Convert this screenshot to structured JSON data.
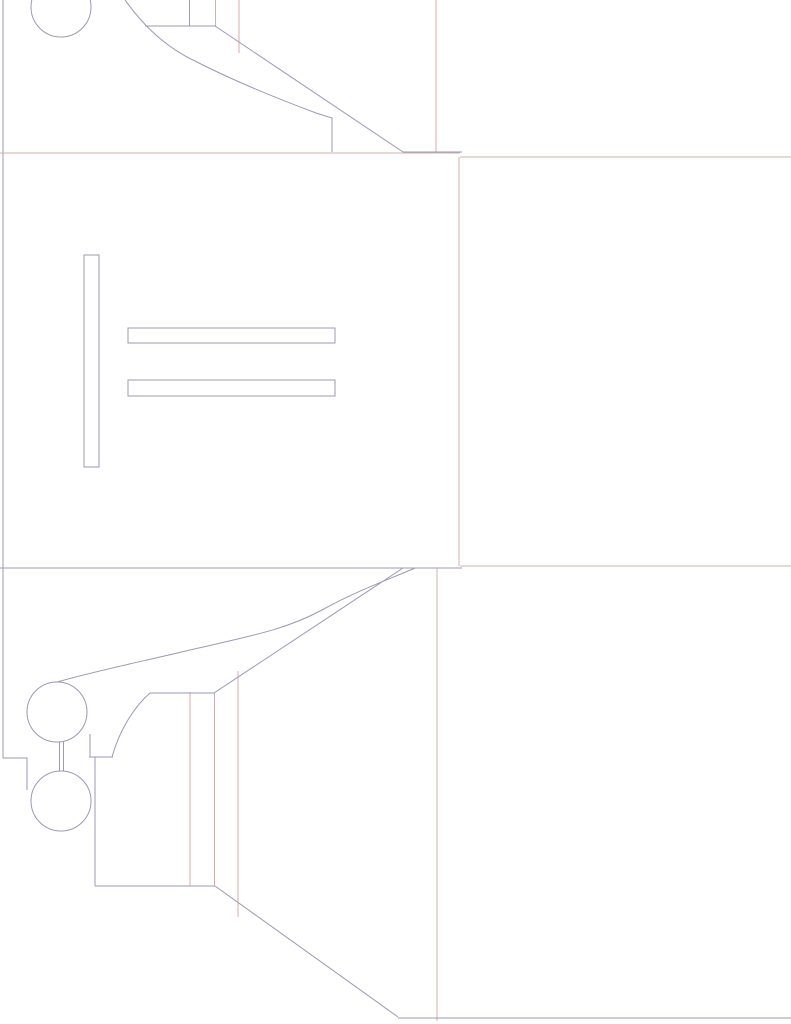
{
  "canvas": {
    "width": 791,
    "height": 1024,
    "background": "#ffffff"
  },
  "colors": {
    "cut": "#9b99b5",
    "fold": "#d9aca9"
  },
  "dieline": {
    "kind": "die-cut-box-template",
    "circles": [
      {
        "name": "top-lock-circle",
        "cx": 61,
        "cy": 7,
        "r": 30,
        "stroke": "cut"
      },
      {
        "name": "bottom-lock-circle-upper",
        "cx": 57,
        "cy": 712,
        "r": 30,
        "stroke": "cut"
      },
      {
        "name": "bottom-lock-circle-lower",
        "cx": 61,
        "cy": 801,
        "r": 30,
        "stroke": "cut"
      }
    ],
    "rects": [
      {
        "name": "vertical-slot",
        "x": 84,
        "y": 255,
        "w": 15,
        "h": 212,
        "stroke": "cut"
      },
      {
        "name": "horizontal-slot-1",
        "x": 128,
        "y": 328,
        "w": 207,
        "h": 15,
        "stroke": "cut"
      },
      {
        "name": "horizontal-slot-2",
        "x": 128,
        "y": 380,
        "w": 207,
        "h": 16,
        "stroke": "cut"
      }
    ],
    "paths": [
      {
        "name": "top-flap-curve",
        "d": "M 125 0 C 138 18 160 45 197 62 C 240 84 292 104 316 113 L 332 118 L 332 152",
        "stroke": "cut"
      },
      {
        "name": "top-flap-edge",
        "d": "M 145 26 L 215 26 L 403 152",
        "stroke": "cut"
      },
      {
        "name": "bottom-flap-curve-outer",
        "d": "M 57 682 C 95 671 140 662 190 650 C 250 636 285 630 322 610 C 358 590 395 577 415 568",
        "stroke": "cut"
      },
      {
        "name": "bottom-flap-edge",
        "d": "M 403 568 L 214 693 L 150 693",
        "stroke": "cut"
      },
      {
        "name": "bottom-flap-curve-inner",
        "d": "M 150 693 C 136 705 120 728 112 757",
        "stroke": "cut"
      },
      {
        "name": "lock-step",
        "d": "M 3 758 L 27 758 L 27 790",
        "stroke": "cut"
      }
    ],
    "lines": [
      {
        "name": "left-edge",
        "x1": 3,
        "y1": 0,
        "x2": 3,
        "y2": 758,
        "stroke": "cut"
      },
      {
        "name": "top-vertical-a",
        "x1": 189.5,
        "y1": 0,
        "x2": 189.5,
        "y2": 26,
        "stroke": "cut"
      },
      {
        "name": "top-fold-vertical-b",
        "x1": 215.5,
        "y1": 0,
        "x2": 215.5,
        "y2": 26,
        "stroke": "fold"
      },
      {
        "name": "top-fold-vertical-c",
        "x1": 239,
        "y1": 0,
        "x2": 239,
        "y2": 53,
        "stroke": "fold"
      },
      {
        "name": "top-fold-vertical-d",
        "x1": 436,
        "y1": 0,
        "x2": 436,
        "y2": 153,
        "stroke": "fold"
      },
      {
        "name": "main-fold-top",
        "x1": 0,
        "y1": 153,
        "x2": 460,
        "y2": 153,
        "stroke": "fold"
      },
      {
        "name": "top-fold-cut-segment",
        "x1": 403,
        "y1": 152,
        "x2": 462,
        "y2": 152,
        "stroke": "cut"
      },
      {
        "name": "right-panel-top",
        "x1": 460,
        "y1": 157,
        "x2": 791,
        "y2": 157,
        "stroke": "fold"
      },
      {
        "name": "right-panel-left",
        "x1": 459,
        "y1": 157,
        "x2": 459,
        "y2": 566,
        "stroke": "fold"
      },
      {
        "name": "right-panel-bottom",
        "x1": 460,
        "y1": 566,
        "x2": 791,
        "y2": 566,
        "stroke": "fold"
      },
      {
        "name": "main-fold-bottom",
        "x1": 0,
        "y1": 568,
        "x2": 462,
        "y2": 568,
        "stroke": "cut"
      },
      {
        "name": "bottom-fold-vertical-d",
        "x1": 437,
        "y1": 568,
        "x2": 437,
        "y2": 1021,
        "stroke": "fold"
      },
      {
        "name": "bottom-fold-vertical-a",
        "x1": 190,
        "y1": 692,
        "x2": 190,
        "y2": 886,
        "stroke": "fold"
      },
      {
        "name": "bottom-fold-vertical-b",
        "x1": 214.5,
        "y1": 693,
        "x2": 214.5,
        "y2": 886,
        "stroke": "fold"
      },
      {
        "name": "bottom-fold-vertical-c",
        "x1": 238,
        "y1": 671,
        "x2": 238,
        "y2": 917,
        "stroke": "fold"
      },
      {
        "name": "lock-neck-left",
        "x1": 59.5,
        "y1": 742,
        "x2": 59.5,
        "y2": 771,
        "stroke": "cut"
      },
      {
        "name": "lock-neck-right",
        "x1": 63.5,
        "y1": 742,
        "x2": 63.5,
        "y2": 771,
        "stroke": "cut"
      },
      {
        "name": "lock-circle-tail",
        "x1": 90,
        "y1": 734,
        "x2": 90,
        "y2": 757,
        "stroke": "cut"
      },
      {
        "name": "lock-notch-horizontal",
        "x1": 89,
        "y1": 757,
        "x2": 113,
        "y2": 757,
        "stroke": "cut"
      },
      {
        "name": "tab-drop-vertical",
        "x1": 95,
        "y1": 757,
        "x2": 95,
        "y2": 886,
        "stroke": "cut"
      },
      {
        "name": "bottom-tab-horizontal",
        "x1": 95,
        "y1": 886,
        "x2": 215,
        "y2": 886,
        "stroke": "cut"
      },
      {
        "name": "bottom-tab-diagonal",
        "x1": 215,
        "y1": 886,
        "x2": 398,
        "y2": 1017,
        "stroke": "cut"
      },
      {
        "name": "bottom-edge",
        "x1": 398,
        "y1": 1018,
        "x2": 791,
        "y2": 1018,
        "stroke": "cut"
      }
    ]
  }
}
